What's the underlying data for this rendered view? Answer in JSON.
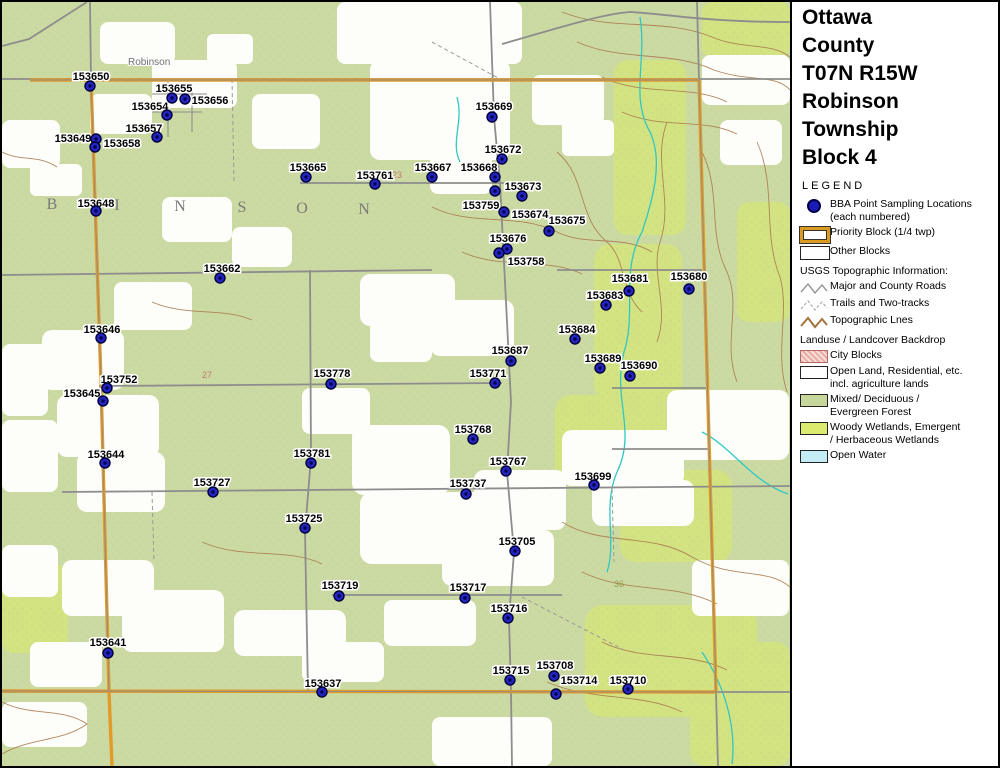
{
  "panel": {
    "title_lines": [
      "Ottawa",
      "County",
      "T07N R15W",
      "Robinson",
      "Township",
      "Block 4"
    ],
    "legend_title": "LEGEND",
    "legend": {
      "items": [
        {
          "type": "dot",
          "lines": [
            "BBA Point Sampling Locations",
            "(each numbered)"
          ]
        },
        {
          "type": "priority",
          "lines": [
            "Priority Block (1/4 twp)"
          ]
        },
        {
          "type": "block",
          "lines": [
            "Other Blocks"
          ]
        },
        {
          "type": "header",
          "lines": [
            "USGS Topographic Information:"
          ]
        },
        {
          "type": "road",
          "lines": [
            "Major and County Roads"
          ]
        },
        {
          "type": "trail",
          "lines": [
            "Trails and Two-tracks"
          ]
        },
        {
          "type": "topo",
          "lines": [
            "Topographic Lnes"
          ]
        },
        {
          "type": "header",
          "lines": [
            "Landuse / Landcover Backdrop"
          ]
        },
        {
          "type": "city",
          "lines": [
            "City Blocks"
          ]
        },
        {
          "type": "open",
          "lines": [
            "Open Land, Residential, etc.",
            "incl. agriculture lands"
          ]
        },
        {
          "type": "forest",
          "lines": [
            "Mixed/ Deciduous /",
            "Evergreen Forest"
          ]
        },
        {
          "type": "wetland",
          "lines": [
            "Woody Wetlands, Emergent",
            "/ Herbaceous Wetlands"
          ]
        },
        {
          "type": "water",
          "lines": [
            "Open Water"
          ]
        }
      ]
    },
    "logo": {
      "name": "MICHIGAN",
      "subtitle": "Breeding Bird Atlas",
      "years": "2002 - 2007",
      "numeral": "II"
    },
    "north_label": "N",
    "scalebars": {
      "miles": {
        "ticks": [
          "0",
          "0.1",
          "0.2",
          "0.3",
          "0.4",
          "0.5"
        ],
        "unit": "Miles",
        "cell_px": 20
      },
      "km": {
        "ticks": [
          "0",
          "0.2",
          "0.4",
          "0.6"
        ],
        "unit": "Kilometers",
        "cell_px": 26
      }
    },
    "rev_note": "(rev. 2005 may 18)"
  },
  "map": {
    "town_label": {
      "text": "Robinson",
      "x": 126,
      "y": 63
    },
    "township_letters": [
      {
        "t": "B",
        "x": 50,
        "y": 207
      },
      {
        "t": "I",
        "x": 115,
        "y": 208
      },
      {
        "t": "N",
        "x": 178,
        "y": 209
      },
      {
        "t": "S",
        "x": 240,
        "y": 210
      },
      {
        "t": "O",
        "x": 300,
        "y": 211
      },
      {
        "t": "N",
        "x": 362,
        "y": 212
      }
    ],
    "section_labels": [
      {
        "t": "23",
        "x": 395,
        "y": 176,
        "c": "#c46a6a"
      },
      {
        "t": "27",
        "x": 205,
        "y": 376,
        "c": "#c46a6a"
      },
      {
        "t": "36",
        "x": 617,
        "y": 585,
        "c": "#8f8f40"
      }
    ],
    "points": [
      {
        "id": "153650",
        "x": 88,
        "y": 84,
        "lx": 89,
        "ly": 74
      },
      {
        "id": "153655",
        "x": 170,
        "y": 96,
        "lx": 172,
        "ly": 86
      },
      {
        "id": "153656",
        "x": 183,
        "y": 97,
        "lx": 208,
        "ly": 98
      },
      {
        "id": "153654",
        "x": 165,
        "y": 113,
        "lx": 148,
        "ly": 104
      },
      {
        "id": "153657",
        "x": 155,
        "y": 135,
        "lx": 142,
        "ly": 126
      },
      {
        "id": "153649",
        "x": 94,
        "y": 137,
        "lx": 71,
        "ly": 136
      },
      {
        "id": "153658",
        "x": 93,
        "y": 145,
        "lx": 120,
        "ly": 141
      },
      {
        "id": "153648",
        "x": 94,
        "y": 209,
        "lx": 94,
        "ly": 201
      },
      {
        "id": "153669",
        "x": 490,
        "y": 115,
        "lx": 492,
        "ly": 104
      },
      {
        "id": "153665",
        "x": 304,
        "y": 175,
        "lx": 306,
        "ly": 165
      },
      {
        "id": "153761",
        "x": 373,
        "y": 182,
        "lx": 373,
        "ly": 173
      },
      {
        "id": "153667",
        "x": 430,
        "y": 175,
        "lx": 431,
        "ly": 165
      },
      {
        "id": "153668",
        "x": 493,
        "y": 175,
        "lx": 477,
        "ly": 165
      },
      {
        "id": "153672",
        "x": 500,
        "y": 157,
        "lx": 501,
        "ly": 147
      },
      {
        "id": "153673",
        "x": 520,
        "y": 194,
        "lx": 521,
        "ly": 184
      },
      {
        "id": "153674",
        "x": 493,
        "y": 189,
        "lx": 528,
        "ly": 212
      },
      {
        "id": "153759",
        "x": 502,
        "y": 210,
        "lx": 479,
        "ly": 203
      },
      {
        "id": "153675",
        "x": 547,
        "y": 229,
        "lx": 565,
        "ly": 218
      },
      {
        "id": "153676",
        "x": 505,
        "y": 247,
        "lx": 506,
        "ly": 236
      },
      {
        "id": "153758",
        "x": 497,
        "y": 251,
        "lx": 524,
        "ly": 259
      },
      {
        "id": "153662",
        "x": 218,
        "y": 276,
        "lx": 220,
        "ly": 266
      },
      {
        "id": "153681",
        "x": 627,
        "y": 289,
        "lx": 628,
        "ly": 276
      },
      {
        "id": "153680",
        "x": 687,
        "y": 287,
        "lx": 687,
        "ly": 274
      },
      {
        "id": "153683",
        "x": 604,
        "y": 303,
        "lx": 603,
        "ly": 293
      },
      {
        "id": "153646",
        "x": 99,
        "y": 336,
        "lx": 100,
        "ly": 327
      },
      {
        "id": "153684",
        "x": 573,
        "y": 337,
        "lx": 575,
        "ly": 327
      },
      {
        "id": "153687",
        "x": 509,
        "y": 359,
        "lx": 508,
        "ly": 348
      },
      {
        "id": "153689",
        "x": 598,
        "y": 366,
        "lx": 601,
        "ly": 356
      },
      {
        "id": "153690",
        "x": 628,
        "y": 374,
        "lx": 637,
        "ly": 363
      },
      {
        "id": "153752",
        "x": 105,
        "y": 386,
        "lx": 117,
        "ly": 377
      },
      {
        "id": "153778",
        "x": 329,
        "y": 382,
        "lx": 330,
        "ly": 371
      },
      {
        "id": "153771",
        "x": 493,
        "y": 381,
        "lx": 486,
        "ly": 371
      },
      {
        "id": "153645",
        "x": 101,
        "y": 399,
        "lx": 80,
        "ly": 391
      },
      {
        "id": "153768",
        "x": 471,
        "y": 437,
        "lx": 471,
        "ly": 427
      },
      {
        "id": "153644",
        "x": 103,
        "y": 461,
        "lx": 104,
        "ly": 452
      },
      {
        "id": "153781",
        "x": 309,
        "y": 461,
        "lx": 310,
        "ly": 451
      },
      {
        "id": "153767",
        "x": 504,
        "y": 469,
        "lx": 506,
        "ly": 459
      },
      {
        "id": "153699",
        "x": 592,
        "y": 483,
        "lx": 591,
        "ly": 474
      },
      {
        "id": "153727",
        "x": 211,
        "y": 490,
        "lx": 210,
        "ly": 480
      },
      {
        "id": "153737",
        "x": 464,
        "y": 492,
        "lx": 466,
        "ly": 481
      },
      {
        "id": "153725",
        "x": 303,
        "y": 526,
        "lx": 302,
        "ly": 516
      },
      {
        "id": "153705",
        "x": 513,
        "y": 549,
        "lx": 515,
        "ly": 539
      },
      {
        "id": "153719",
        "x": 337,
        "y": 594,
        "lx": 338,
        "ly": 583
      },
      {
        "id": "153717",
        "x": 463,
        "y": 596,
        "lx": 466,
        "ly": 585
      },
      {
        "id": "153716",
        "x": 506,
        "y": 616,
        "lx": 507,
        "ly": 606
      },
      {
        "id": "153641",
        "x": 106,
        "y": 651,
        "lx": 106,
        "ly": 640
      },
      {
        "id": "153715",
        "x": 508,
        "y": 678,
        "lx": 509,
        "ly": 668
      },
      {
        "id": "153708",
        "x": 552,
        "y": 674,
        "lx": 553,
        "ly": 663
      },
      {
        "id": "153714",
        "x": 554,
        "y": 692,
        "lx": 577,
        "ly": 678
      },
      {
        "id": "153710",
        "x": 626,
        "y": 687,
        "lx": 626,
        "ly": 678
      },
      {
        "id": "153637",
        "x": 320,
        "y": 690,
        "lx": 321,
        "ly": 681
      }
    ]
  },
  "colors": {
    "point_blue": "#2424c0",
    "point_core": "#05054a",
    "priority_orange": "#e39b27",
    "forest_green": "#cbdaa3",
    "wetland_green": "#d3e381",
    "water_blue": "#c3ecf7",
    "city_pink": "#e7aca2",
    "road_gray": "#8d8d8d",
    "contour_brown": "#ab7a4e",
    "stream_cyan": "#30c8c4"
  }
}
